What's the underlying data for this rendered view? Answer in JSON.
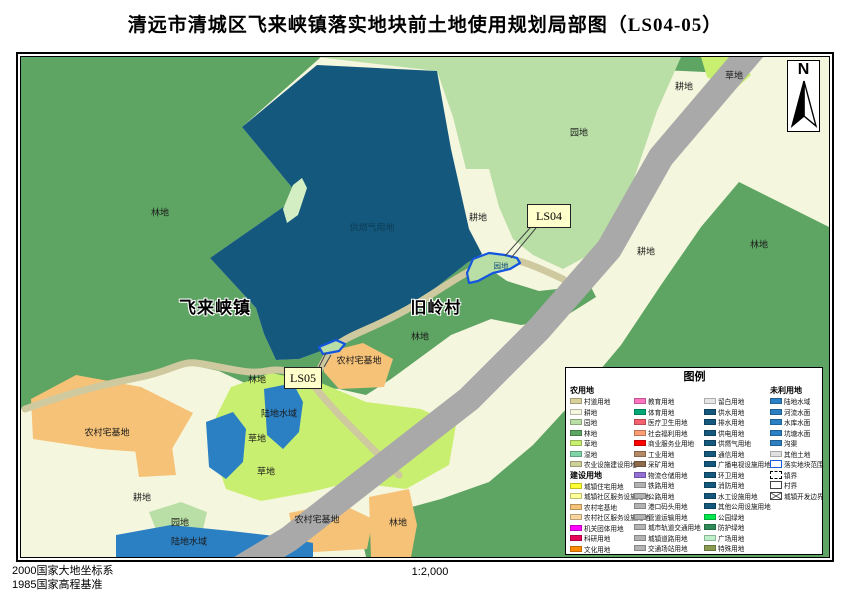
{
  "title": "清远市清城区飞来峡镇落实地块前土地使用规划局部图（LS04-05）",
  "north_label": "N",
  "scale": "1:2,000",
  "datum": {
    "line1": "2000国家大地坐标系",
    "line2": "1985国家高程基准"
  },
  "map": {
    "town_label": "飞来峡镇",
    "village_label": "旧岭村",
    "parcels": [
      {
        "tag": "LS04",
        "landuse": "园地"
      },
      {
        "tag": "LS05"
      }
    ],
    "labels": [
      {
        "text": "林地",
        "x": 139,
        "y": 155,
        "kind": "area"
      },
      {
        "text": "供燃气用地",
        "x": 351,
        "y": 170,
        "kind": "area-dark"
      },
      {
        "text": "耕地",
        "x": 457,
        "y": 160,
        "kind": "area"
      },
      {
        "text": "园地",
        "x": 558,
        "y": 75,
        "kind": "area"
      },
      {
        "text": "耕地",
        "x": 663,
        "y": 29,
        "kind": "area"
      },
      {
        "text": "草地",
        "x": 713,
        "y": 18,
        "kind": "area"
      },
      {
        "text": "林地",
        "x": 738,
        "y": 187,
        "kind": "area"
      },
      {
        "text": "耕地",
        "x": 625,
        "y": 194,
        "kind": "area"
      },
      {
        "text": "园地",
        "x": 480,
        "y": 209,
        "kind": "parcel-tiny"
      },
      {
        "text": "飞来峡镇",
        "x": 194,
        "y": 249,
        "kind": "town"
      },
      {
        "text": "旧岭村",
        "x": 415,
        "y": 249,
        "kind": "village"
      },
      {
        "text": "林地",
        "x": 399,
        "y": 279,
        "kind": "area"
      },
      {
        "text": "农村宅基地",
        "x": 338,
        "y": 303,
        "kind": "area"
      },
      {
        "text": "林地",
        "x": 236,
        "y": 322,
        "kind": "area"
      },
      {
        "text": "陆地水域",
        "x": 258,
        "y": 356,
        "kind": "area"
      },
      {
        "text": "农村宅基地",
        "x": 86,
        "y": 375,
        "kind": "area"
      },
      {
        "text": "草地",
        "x": 236,
        "y": 381,
        "kind": "area"
      },
      {
        "text": "草地",
        "x": 245,
        "y": 414,
        "kind": "area"
      },
      {
        "text": "耕地",
        "x": 121,
        "y": 440,
        "kind": "area"
      },
      {
        "text": "园地",
        "x": 159,
        "y": 465,
        "kind": "area"
      },
      {
        "text": "陆地水域",
        "x": 168,
        "y": 484,
        "kind": "area"
      },
      {
        "text": "农村宅基地",
        "x": 296,
        "y": 462,
        "kind": "area"
      },
      {
        "text": "林地",
        "x": 377,
        "y": 465,
        "kind": "area"
      }
    ]
  },
  "legend": {
    "title": "图例",
    "columns": [
      {
        "blocks": [
          {
            "header": "农用地",
            "items": [
              {
                "label": "村道用地",
                "color": "#d8d29a"
              },
              {
                "label": "耕地",
                "color": "#f4f6dd"
              },
              {
                "label": "园地",
                "color": "#b9dfa6"
              },
              {
                "label": "林地",
                "color": "#5ea463"
              },
              {
                "label": "草地",
                "color": "#c9ef70"
              },
              {
                "label": "湿地",
                "color": "#7fd4a8"
              },
              {
                "label": "农业设施建设用地",
                "color": "#cfcf9a"
              }
            ]
          },
          {
            "header": "建设用地",
            "items": [
              {
                "label": "城镇住宅用地",
                "color": "#ffff33"
              },
              {
                "label": "城镇社区服务设施用地",
                "color": "#ffff99"
              },
              {
                "label": "农村宅基地",
                "color": "#f6c278"
              },
              {
                "label": "农村社区服务设施用地",
                "color": "#f8d49e"
              },
              {
                "label": "机关团体用地",
                "color": "#ff00ff"
              },
              {
                "label": "科研用地",
                "color": "#e6005c"
              },
              {
                "label": "文化用地",
                "color": "#ff8c00"
              }
            ]
          }
        ]
      },
      {
        "blocks": [
          {
            "header": null,
            "items": [
              {
                "label": "教育用地",
                "color": "#ff73c0"
              },
              {
                "label": "体育用地",
                "color": "#00a878"
              },
              {
                "label": "医疗卫生用地",
                "color": "#f4626d"
              },
              {
                "label": "社会福利用地",
                "color": "#fa9c74"
              },
              {
                "label": "商业服务业用地",
                "color": "#ff0000"
              },
              {
                "label": "工业用地",
                "color": "#b58a66"
              },
              {
                "label": "采矿用地",
                "color": "#8f6b4e"
              },
              {
                "label": "物流仓储用地",
                "color": "#9470d4"
              },
              {
                "label": "铁路用地",
                "color": "#b3b3b3"
              },
              {
                "label": "公路用地",
                "color": "#b3b3b3"
              },
              {
                "label": "港口码头用地",
                "color": "#b3b3b3"
              },
              {
                "label": "管道运输用地",
                "color": "#b3b3b3"
              },
              {
                "label": "城市轨道交通用地",
                "color": "#b3b3b3"
              },
              {
                "label": "城镇道路用地",
                "color": "#b3b3b3"
              },
              {
                "label": "交通场站用地",
                "color": "#b3b3b3"
              }
            ]
          }
        ]
      },
      {
        "blocks": [
          {
            "header": null,
            "items": [
              {
                "label": "留白用地",
                "color": "#e6e6e6"
              },
              {
                "label": "供水用地",
                "color": "#14597d"
              },
              {
                "label": "排水用地",
                "color": "#14597d"
              },
              {
                "label": "供电用地",
                "color": "#14597d"
              },
              {
                "label": "供燃气用地",
                "color": "#14597d"
              },
              {
                "label": "通信用地",
                "color": "#14597d"
              },
              {
                "label": "广播电视设施用地",
                "color": "#14597d"
              },
              {
                "label": "环卫用地",
                "color": "#14597d"
              },
              {
                "label": "消防用地",
                "color": "#14597d"
              },
              {
                "label": "水工设施用地",
                "color": "#14597d"
              },
              {
                "label": "其他公用设施用地",
                "color": "#14597d"
              },
              {
                "label": "公园绿地",
                "color": "#00e64d"
              },
              {
                "label": "防护绿地",
                "color": "#2e8b57"
              },
              {
                "label": "广场用地",
                "color": "#bdf0c8"
              },
              {
                "label": "特殊用地",
                "color": "#8a9a50"
              }
            ]
          }
        ]
      },
      {
        "blocks": [
          {
            "header": "未利用地",
            "items": [
              {
                "label": "陆地水域",
                "color": "#2b80c4"
              },
              {
                "label": "河流水面",
                "color": "#2b80c4"
              },
              {
                "label": "水库水面",
                "color": "#2b80c4"
              },
              {
                "label": "坑塘水面",
                "color": "#2b80c4"
              },
              {
                "label": "沟渠",
                "color": "#2b80c4"
              },
              {
                "label": "其他土地",
                "color": "#e0e0e0"
              },
              {
                "label": "落实地块范围",
                "swatch": "outline-blue"
              },
              {
                "label": "镇界",
                "swatch": "dashed"
              },
              {
                "label": "村界",
                "swatch": "outline"
              },
              {
                "label": "城镇开发边界",
                "swatch": "cross"
              }
            ]
          }
        ]
      }
    ]
  },
  "palette": {
    "forest": "#5ea463",
    "orchard": "#b9dfa6",
    "cropland": "#f5f6de",
    "grass": "#c9ef70",
    "water": "#2b80c4",
    "gas_supply": "#14597d",
    "rural_housing": "#f6c278",
    "highway": "#a9a9a9",
    "village_road": "#cfc9a0",
    "parcel_outline": "#1455e0",
    "callout_bg": "#ffffcc"
  }
}
